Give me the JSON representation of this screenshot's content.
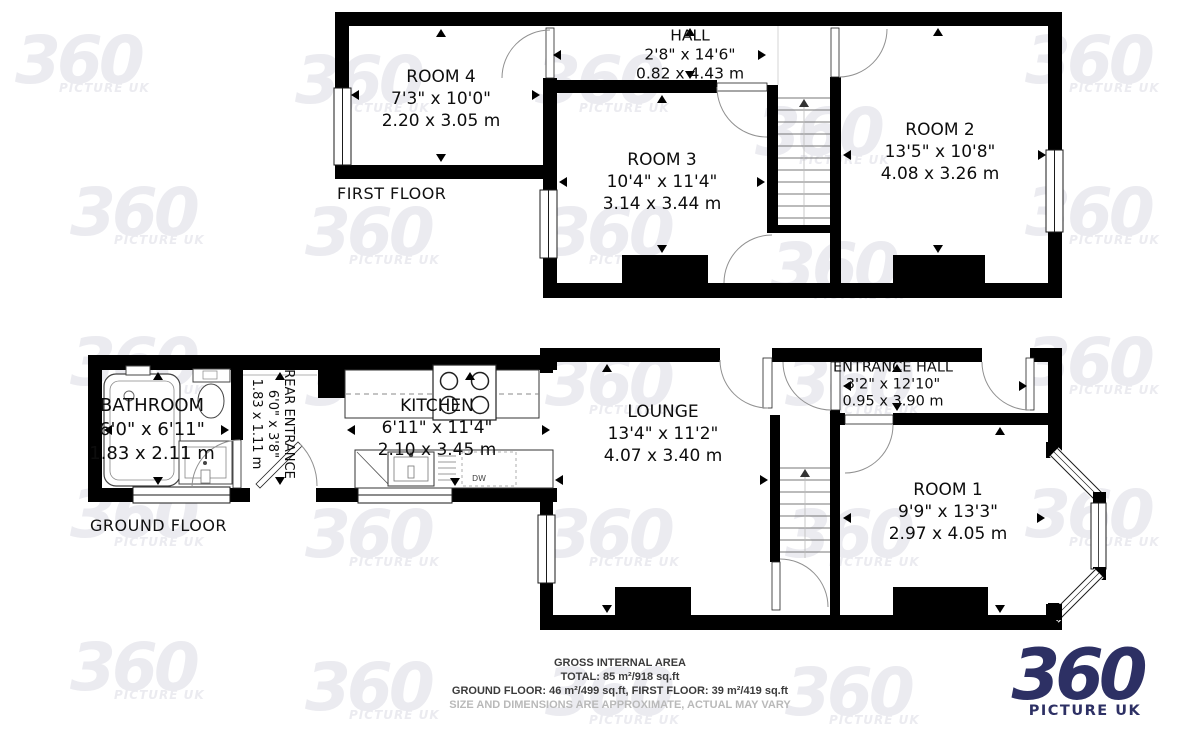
{
  "floors": {
    "first": {
      "label": "FIRST FLOOR",
      "rooms": {
        "room4": {
          "name": "ROOM 4",
          "imperial": "7'3\" x 10'0\"",
          "metric": "2.20 x 3.05 m"
        },
        "hall": {
          "name": "HALL",
          "imperial": "2'8\" x 14'6\"",
          "metric": "0.82 x 4.43 m"
        },
        "room3": {
          "name": "ROOM 3",
          "imperial": "10'4\" x 11'4\"",
          "metric": "3.14 x 3.44 m"
        },
        "room2": {
          "name": "ROOM 2",
          "imperial": "13'5\" x 10'8\"",
          "metric": "4.08 x 3.26 m"
        }
      }
    },
    "ground": {
      "label": "GROUND FLOOR",
      "rooms": {
        "bathroom": {
          "name": "BATHROOM",
          "imperial": "6'0\" x 6'11\"",
          "metric": "1.83 x 2.11 m"
        },
        "rear_entrance": {
          "name": "REAR ENTRANCE",
          "imperial": "6'0\" x 3'8\"",
          "metric": "1.83 x 1.11 m"
        },
        "kitchen": {
          "name": "KITCHEN",
          "imperial": "6'11\" x 11'4\"",
          "metric": "2.10 x 3.45 m"
        },
        "lounge": {
          "name": "LOUNGE",
          "imperial": "13'4\" x 11'2\"",
          "metric": "4.07 x 3.40 m"
        },
        "entrance_hall": {
          "name": "ENTRANCE HALL",
          "imperial": "3'2\" x 12'10\"",
          "metric": "0.95 x 3.90 m"
        },
        "room1": {
          "name": "ROOM 1",
          "imperial": "9'9\" x 13'3\"",
          "metric": "2.97 x 4.05 m"
        }
      }
    }
  },
  "appliances": {
    "dishwasher": "DW"
  },
  "footer": {
    "line1": "GROSS INTERNAL AREA",
    "line2": "TOTAL: 85 m²/918 sq.ft",
    "line3": "GROUND FLOOR: 46 m²/499 sq.ft, FIRST FLOOR: 39 m²/419 sq.ft",
    "line4": "SIZE AND DIMENSIONS ARE APPROXIMATE, ACTUAL MAY VARY"
  },
  "branding": {
    "logo_big": "360",
    "logo_small": "PICTURE UK"
  },
  "watermark": {
    "big": "360",
    "small": "PICTURE UK"
  },
  "colors": {
    "wall": "#000000",
    "logo_navy": "#2d3064",
    "watermark": "#ebebf0"
  }
}
